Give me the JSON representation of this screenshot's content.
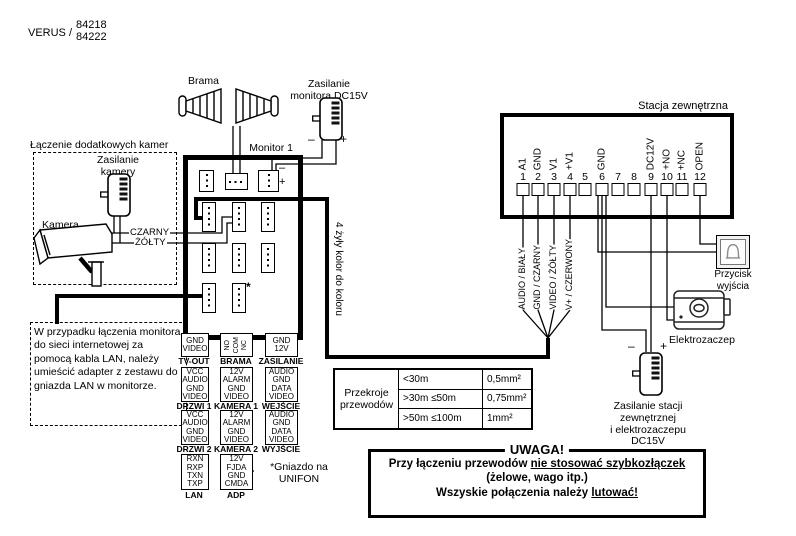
{
  "colors": {
    "ink": "#000000",
    "paper": "#ffffff"
  },
  "header": {
    "brand": "VERUS /",
    "model_top": "84218",
    "model_bottom": "84222"
  },
  "gate": {
    "label": "Brama"
  },
  "monitor_power": {
    "line1": "Zasilanie",
    "line2": "monitora DC15V",
    "minus": "–",
    "plus": "+"
  },
  "camera_box": {
    "title": "Łączenie dodatkowych kamer",
    "power_line1": "Zasilanie",
    "power_line2": "kamery",
    "camera_label": "Kamera",
    "wire_black": "CZARNY",
    "wire_yellow": "ŻÓŁTY"
  },
  "monitor": {
    "title": "Monitor 1",
    "minus": "–",
    "plus": "+",
    "asterisk": "*",
    "cable_note": "4 żyły kolor do koloru"
  },
  "ports": {
    "tvout": {
      "label": "TV-OUT",
      "pins": [
        "GND",
        "VIDEO"
      ]
    },
    "brama": {
      "label": "BRAMA",
      "pins": [
        "NO",
        "COM",
        "NC"
      ]
    },
    "zasilanie": {
      "label": "ZASILANIE",
      "pins": [
        "GND",
        "12V"
      ]
    },
    "drzwi1": {
      "label": "DRZWI 1",
      "pins": [
        "VCC",
        "AUDIO",
        "GND",
        "VIDEO"
      ]
    },
    "kamera1": {
      "label": "KAMERA 1",
      "pins": [
        "12V",
        "ALARM",
        "GND",
        "VIDEO"
      ]
    },
    "wejscie": {
      "label": "WEJŚCIE",
      "pins": [
        "AUDIO",
        "GND",
        "DATA",
        "VIDEO"
      ]
    },
    "drzwi2": {
      "label": "DRZWI 2",
      "pins": [
        "VCC",
        "AUDIO",
        "GND",
        "VIDEO"
      ]
    },
    "kamera2": {
      "label": "KAMERA 2",
      "pins": [
        "12V",
        "ALARM",
        "GND",
        "VIDEO"
      ]
    },
    "wyjscie": {
      "label": "WYJŚCIE",
      "pins": [
        "AUDIO",
        "GND",
        "DATA",
        "VIDEO"
      ]
    },
    "lan": {
      "label": "LAN",
      "pins": [
        "RXN",
        "RXP",
        "TXN",
        "TXP"
      ]
    },
    "adp": {
      "label": "ADP",
      "pins": [
        "12V",
        "FJDA",
        "GND",
        "CMDA"
      ]
    }
  },
  "lan_note": "W przypadku łączenia monitora do sieci internetowej za pomocą kabla LAN, należy umieścić adapter z zestawu do gniazda LAN w monitorze.",
  "unifon_note": {
    "line1": "*Gniazdo na",
    "line2": "UNIFON"
  },
  "station": {
    "title": "Stacja zewnętrzna",
    "terminals": [
      {
        "num": "1",
        "label": "A1"
      },
      {
        "num": "2",
        "label": "GND"
      },
      {
        "num": "3",
        "label": "V1"
      },
      {
        "num": "4",
        "label": "+V1"
      },
      {
        "num": "5",
        "label": ""
      },
      {
        "num": "6",
        "label": "GND"
      },
      {
        "num": "7",
        "label": ""
      },
      {
        "num": "8",
        "label": ""
      },
      {
        "num": "9",
        "label": "DC12V"
      },
      {
        "num": "10",
        "label": "+NO"
      },
      {
        "num": "11",
        "label": "+NC"
      },
      {
        "num": "12",
        "label": "OPEN"
      }
    ]
  },
  "cable_wires": [
    "AUDIO / BIAŁY",
    "GND / CZARNY",
    "VIDEO / ŻÓŁTY",
    "V+ / CZERWONY"
  ],
  "devices": {
    "exit_button_line1": "Przycisk",
    "exit_button_line2": "wyjścia",
    "strike_label": "Elektrozaczep",
    "station_power": {
      "line1": "Zasilanie stacji",
      "line2": "zewnętrznej",
      "line3": "i elektrozaczepu",
      "line4": "DC15V",
      "minus": "–",
      "plus": "+"
    }
  },
  "wire_table": {
    "header_line1": "Przekroje",
    "header_line2": "przewodów",
    "rows": [
      {
        "range": "<30m",
        "section": "0,5mm²"
      },
      {
        "range": ">30m ≤50m",
        "section": "0,75mm²"
      },
      {
        "range": ">50m ≤100m",
        "section": "1mm²"
      }
    ]
  },
  "warning": {
    "title": "UWAGA!",
    "line1_text": "Przy łączeniu przewodów",
    "line1_underlined": "nie stosować szybkozłączek",
    "line2": "(żelowe, wago itp.)",
    "line3_text": "Wszyskie połączenia należy",
    "line3_underlined": "lutować!"
  }
}
